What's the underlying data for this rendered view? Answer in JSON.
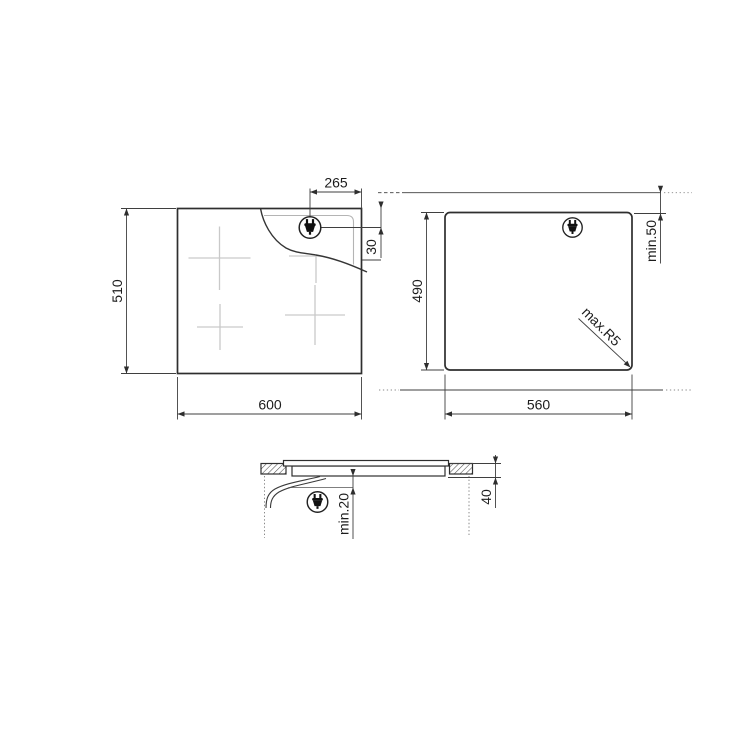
{
  "drawing": {
    "kind": "built-in hob installation dimensions diagram",
    "top_view": {
      "width": "600",
      "height": "510",
      "plug_offset_from_edge": "265",
      "plug_offset_from_top": "30"
    },
    "cutout_view": {
      "width": "560",
      "depth": "490",
      "min_edge_distance": "min.50",
      "max_corner_radius": "max.R5"
    },
    "section_view": {
      "built_in_height": "40",
      "min_clearance_below": "min.20"
    },
    "icons": {
      "power_plug": "power-plug-icon"
    },
    "colors": {
      "background": "#ffffff",
      "drawing_line": "#2e2e2e",
      "dimension_line": "#3f3f3f",
      "cooking_zone_mark": "#c9c9c9",
      "cutout_inner_line": "#b4b4b4",
      "label_text": "#1c1c1c"
    }
  }
}
